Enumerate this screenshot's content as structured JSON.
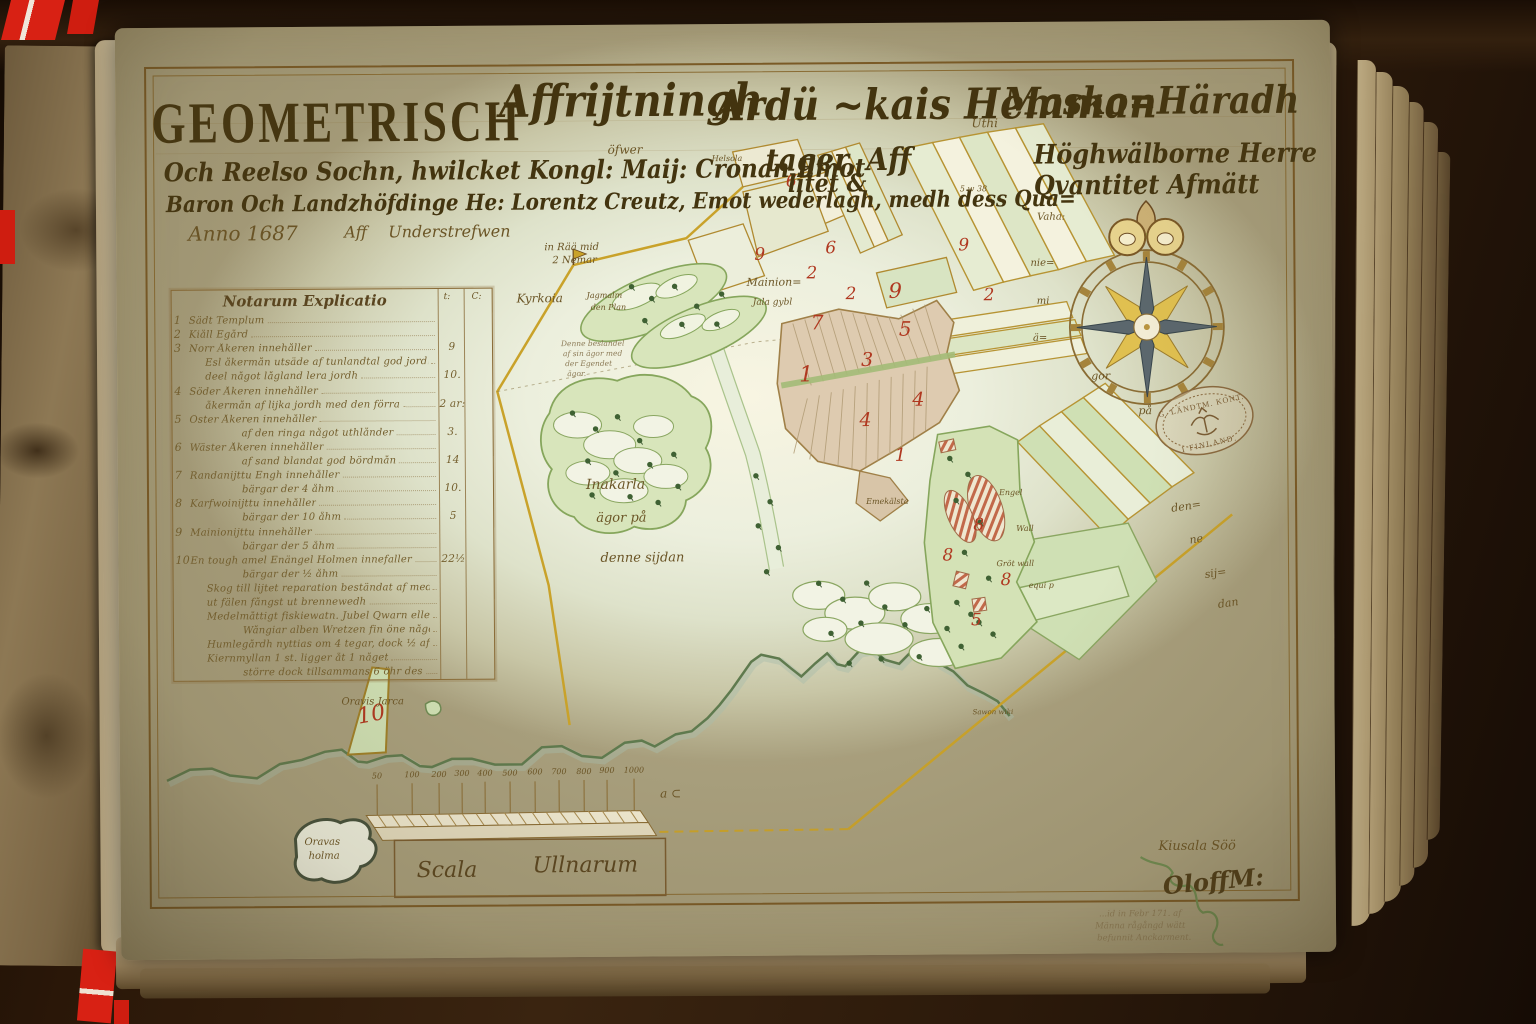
{
  "title": {
    "line1_left": "GEOMETRISCH",
    "line1_script": "Affrijtningh",
    "line1_small1": "öfwer",
    "line1_mid": "Ardü ~kais Hemman",
    "line1_small2": "Uthi",
    "line1_right": "Masko=Häradh",
    "line2_left": "Och Reelso Sochn, hwilcket Kongl: Maij: Cronan Emot",
    "line2_insert": "tager, Aff",
    "line2_right": "Höghwälborne Herre",
    "line3_left": "Baron Och Landzhöfdinge He: Lorentz Creutz, Emot wederlagh, medh dess Qua=",
    "line3_insert": "litet &",
    "line3_right": "Qvantitet Afmätt",
    "line4_anno": "Anno 1687",
    "line4_aff": "Aff",
    "line4_sign": "Understrefwen"
  },
  "notarum": {
    "header": "Notarum Explicatio",
    "col1": "t:",
    "col2": "C:",
    "rows": [
      {
        "no": "1",
        "text": "Sädt Templum",
        "value": ""
      },
      {
        "no": "2",
        "text": "Kiåll Egård",
        "value": ""
      },
      {
        "no": "3",
        "text": "Norr Åkeren innehåller",
        "value": "9"
      },
      {
        "no": "",
        "text": "Esl åkermån utsäde af tunlandtal god jordh, ut en",
        "value": ""
      },
      {
        "no": "",
        "text": "deel något lågland lera jordh",
        "value": "10."
      },
      {
        "no": "4",
        "text": "Söder Åkeren innehåller",
        "value": ""
      },
      {
        "no": "",
        "text": "åkermån af lijka jordh med den förra",
        "value": "2 ar:"
      },
      {
        "no": "5",
        "text": "Öster Åkeren innehåller",
        "value": ""
      },
      {
        "no": "",
        "text": "af den ringa något uthlånder",
        "value": "3."
      },
      {
        "no": "6",
        "text": "Wäster Åkeren innehåller",
        "value": ""
      },
      {
        "no": "",
        "text": "af sand blandat god bördmån",
        "value": "14"
      },
      {
        "no": "7",
        "text": "Randanijttu Engh innehåller",
        "value": ""
      },
      {
        "no": "",
        "text": "bärgar der 4 åhm",
        "value": "10."
      },
      {
        "no": "8",
        "text": "Karfwoinijttu innehåller",
        "value": ""
      },
      {
        "no": "",
        "text": "bärgar der 10 åhm",
        "value": "5"
      },
      {
        "no": "9",
        "text": "Mainionijttu innehåller",
        "value": ""
      },
      {
        "no": "",
        "text": "bärgar der 5 åhm",
        "value": ""
      },
      {
        "no": "10",
        "text": "En tough amel Enängel Holmen innefaller",
        "value": "22½"
      },
      {
        "no": "",
        "text": "bärgar der ½ åhm",
        "value": ""
      },
      {
        "no": "",
        "text": "Skog till lijtet reparation beständat af medelmåttig tall",
        "value": ""
      },
      {
        "no": "",
        "text": "ut fälen fångst ut brennewedh",
        "value": ""
      },
      {
        "no": "",
        "text": "Medelmåttigt fiskiewatn. Jubel Qwarn eller Balla",
        "value": ""
      },
      {
        "no": "",
        "text": "Wångiar alben Wretzen fin öne något afskedlige",
        "value": ""
      },
      {
        "no": "",
        "text": "Humlegårdh nyttias om 4 tegar, dock ½ af—des",
        "value": ""
      },
      {
        "no": "",
        "text": "Kiernmyllan 1 st. ligger åt 1 någet",
        "value": ""
      },
      {
        "no": "",
        "text": "större dock tillsammans 6 öhr des",
        "value": ""
      }
    ]
  },
  "labels": {
    "in_raa": "in Rää mid",
    "nemar": "2 Nemar",
    "kyrkoia": "Kyrkoia",
    "helsola": "Helsola",
    "five38": "5 w 38",
    "mainion": "Mainion=",
    "jala": "Jala gybl",
    "note1": "Denne beslandel",
    "note2": "af sin ägor med",
    "note3": "der Egendet",
    "note4": "ägor.",
    "jagmalm": "Jagmalm",
    "denplan": "den Plan",
    "inakarla": "Inakarla",
    "agor_pa": "ägor på",
    "denne_sijdan": "denne sijdan",
    "vaha": "Vaha:",
    "nie": "nie=",
    "mi": "mi",
    "a_": "ä=",
    "gor": "gor",
    "pa": "på",
    "den_": "den=",
    "ne": "ne",
    "sij": "sij=",
    "dan": "dan",
    "oravis_jarca": "Oravis Jarca",
    "sawon": "Sawon wiki",
    "emekalsta": "Emekälsta",
    "engel": "Engel",
    "wall": "Wall",
    "grotwall": "Gröt wall",
    "equip": "equi p",
    "kiusala": "Kiusala Söö",
    "oravas": "Oravas",
    "holma": "holma"
  },
  "parcels": [
    "6",
    "9",
    "6",
    "2",
    "9",
    "2",
    "7",
    "5",
    "3",
    "1",
    "4",
    "4",
    "1",
    "8",
    "8",
    "8",
    "5",
    "10",
    "2",
    "9"
  ],
  "scale": {
    "ticks": [
      "50",
      "100",
      "200",
      "300",
      "400",
      "500",
      "600",
      "700",
      "800",
      "900",
      "1000"
    ],
    "end_mark": "a ⊂",
    "caption_left": "Scala",
    "caption_right": "Ullnarum"
  },
  "stamp": {
    "top": "G. LÄNDTM. KONT.",
    "bottom": "I FINLAND."
  },
  "signature": "OloffM:",
  "pencil_note": {
    "l1": "...id in Febr 171. af",
    "l2": "Männa rågångd wätt",
    "l3": "befunnit Anckarment."
  }
}
